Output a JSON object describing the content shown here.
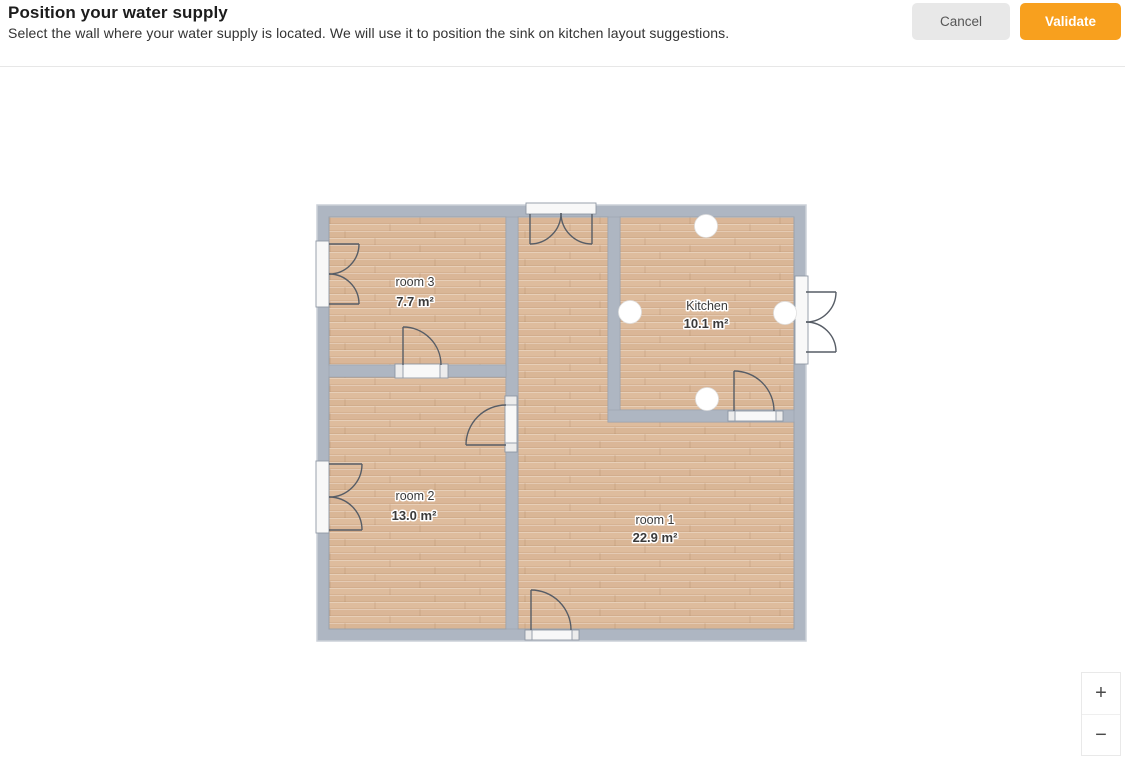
{
  "header": {
    "title": "Position your water supply",
    "subtitle": "Select the wall where your water supply is located. We will use it to position the sink on kitchen layout suggestions.",
    "cancel_label": "Cancel",
    "validate_label": "Validate"
  },
  "plan": {
    "rooms": [
      {
        "name": "room 3",
        "area": "7.7 m²"
      },
      {
        "name": "room 2",
        "area": "13.0 m²"
      },
      {
        "name": "Kitchen",
        "area": "10.1 m²"
      },
      {
        "name": "room 1",
        "area": "22.9 m²"
      }
    ],
    "kitchen_supply_point_walls": [
      "top",
      "left",
      "right",
      "bottom"
    ]
  },
  "zoom_controls": {
    "zoom_in_label": "+",
    "zoom_out_label": "−"
  },
  "colors": {
    "accent_orange": "#f8a01e",
    "cancel_gray": "#e8e8e8",
    "wall_gray": "#aeb6c2",
    "floor_wood": "#debc9d"
  }
}
